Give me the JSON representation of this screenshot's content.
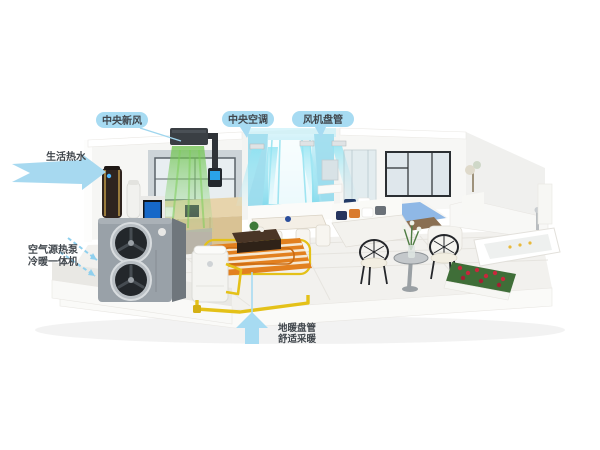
{
  "labels": {
    "fresh_air": "中央新风",
    "hot_water": "生活热水",
    "central_ac": "中央空调",
    "fan_coil": "风机盘管",
    "heat_pump_line1": "空气源热泵",
    "heat_pump_line2": "冷暖一体机",
    "floor_heating_line1": "地暖盘管",
    "floor_heating_line2": "舒适采暖"
  },
  "colors": {
    "label_bubble": "#a7dbf2",
    "label_text": "#41474d",
    "arrow_blue": "#a7d9f0",
    "airflow_cyan": "#9fe8f5",
    "fresh_air_green": "#6cc24a",
    "floor_heating_orange": "#e2801f",
    "pipe_yellow": "#e4c118",
    "heat_pump_gray": "#99a1a8"
  }
}
